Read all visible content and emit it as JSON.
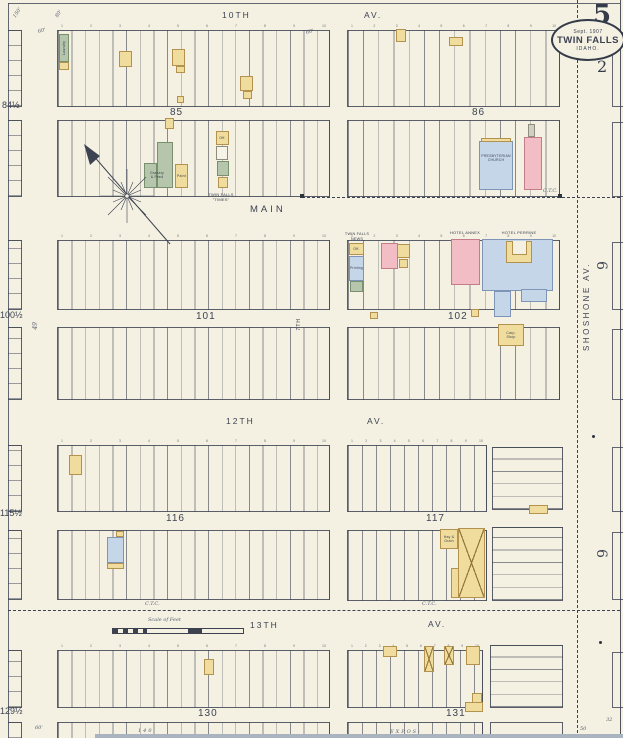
{
  "sheet": {
    "number": "5",
    "secondary": "2",
    "stamp": {
      "date": "Sept. 1907",
      "city": "TWIN FALLS",
      "state": "IDAHO."
    }
  },
  "streets": {
    "tenth": "10TH",
    "tenth_av": "AV.",
    "main": "MAIN",
    "twelfth": "12TH",
    "twelfth_av": "AV.",
    "thirteenth": "13TH",
    "thirteenth_av": "AV.",
    "shoshone": "SHOSHONE AV.",
    "seventh": "7TH"
  },
  "blocks": {
    "b84h": "84½",
    "b85": "85",
    "b86": "86",
    "b100h": "100½",
    "b101": "101",
    "b102": "102",
    "b115h": "115½",
    "b116": "116",
    "b117": "117",
    "b129h": "129½",
    "b130": "130",
    "b131": "131",
    "east6a": "6",
    "east6b": "6"
  },
  "buildings": {
    "laundry": "Laundry",
    "granary": "Granary\n& Feed",
    "paint": "Paint",
    "office": "Off.",
    "printing": "Printing",
    "times": "TWIN FALLS\n\"TIMES\"",
    "news": "TWIN FALLS\nNEWS",
    "church": "PRESBYTERIAN\nCHURCH",
    "annex": "HOTEL ANNEX",
    "perrine": "HOTEL PERRINE",
    "hay": "Hay &\nGrain",
    "carp": "Carp.\nShop"
  },
  "annotations": {
    "scale": "Scale of Feet",
    "ctc": "C.T.C.",
    "expos": "EXPOS-",
    "d150": "150'",
    "d80": "80'",
    "d60": "60'",
    "d49": "49",
    "d140": "140",
    "d50": "50",
    "d32": "32"
  },
  "lot_numbers": [
    "1",
    "2",
    "3",
    "4",
    "5",
    "6",
    "7",
    "8",
    "9",
    "10"
  ]
}
